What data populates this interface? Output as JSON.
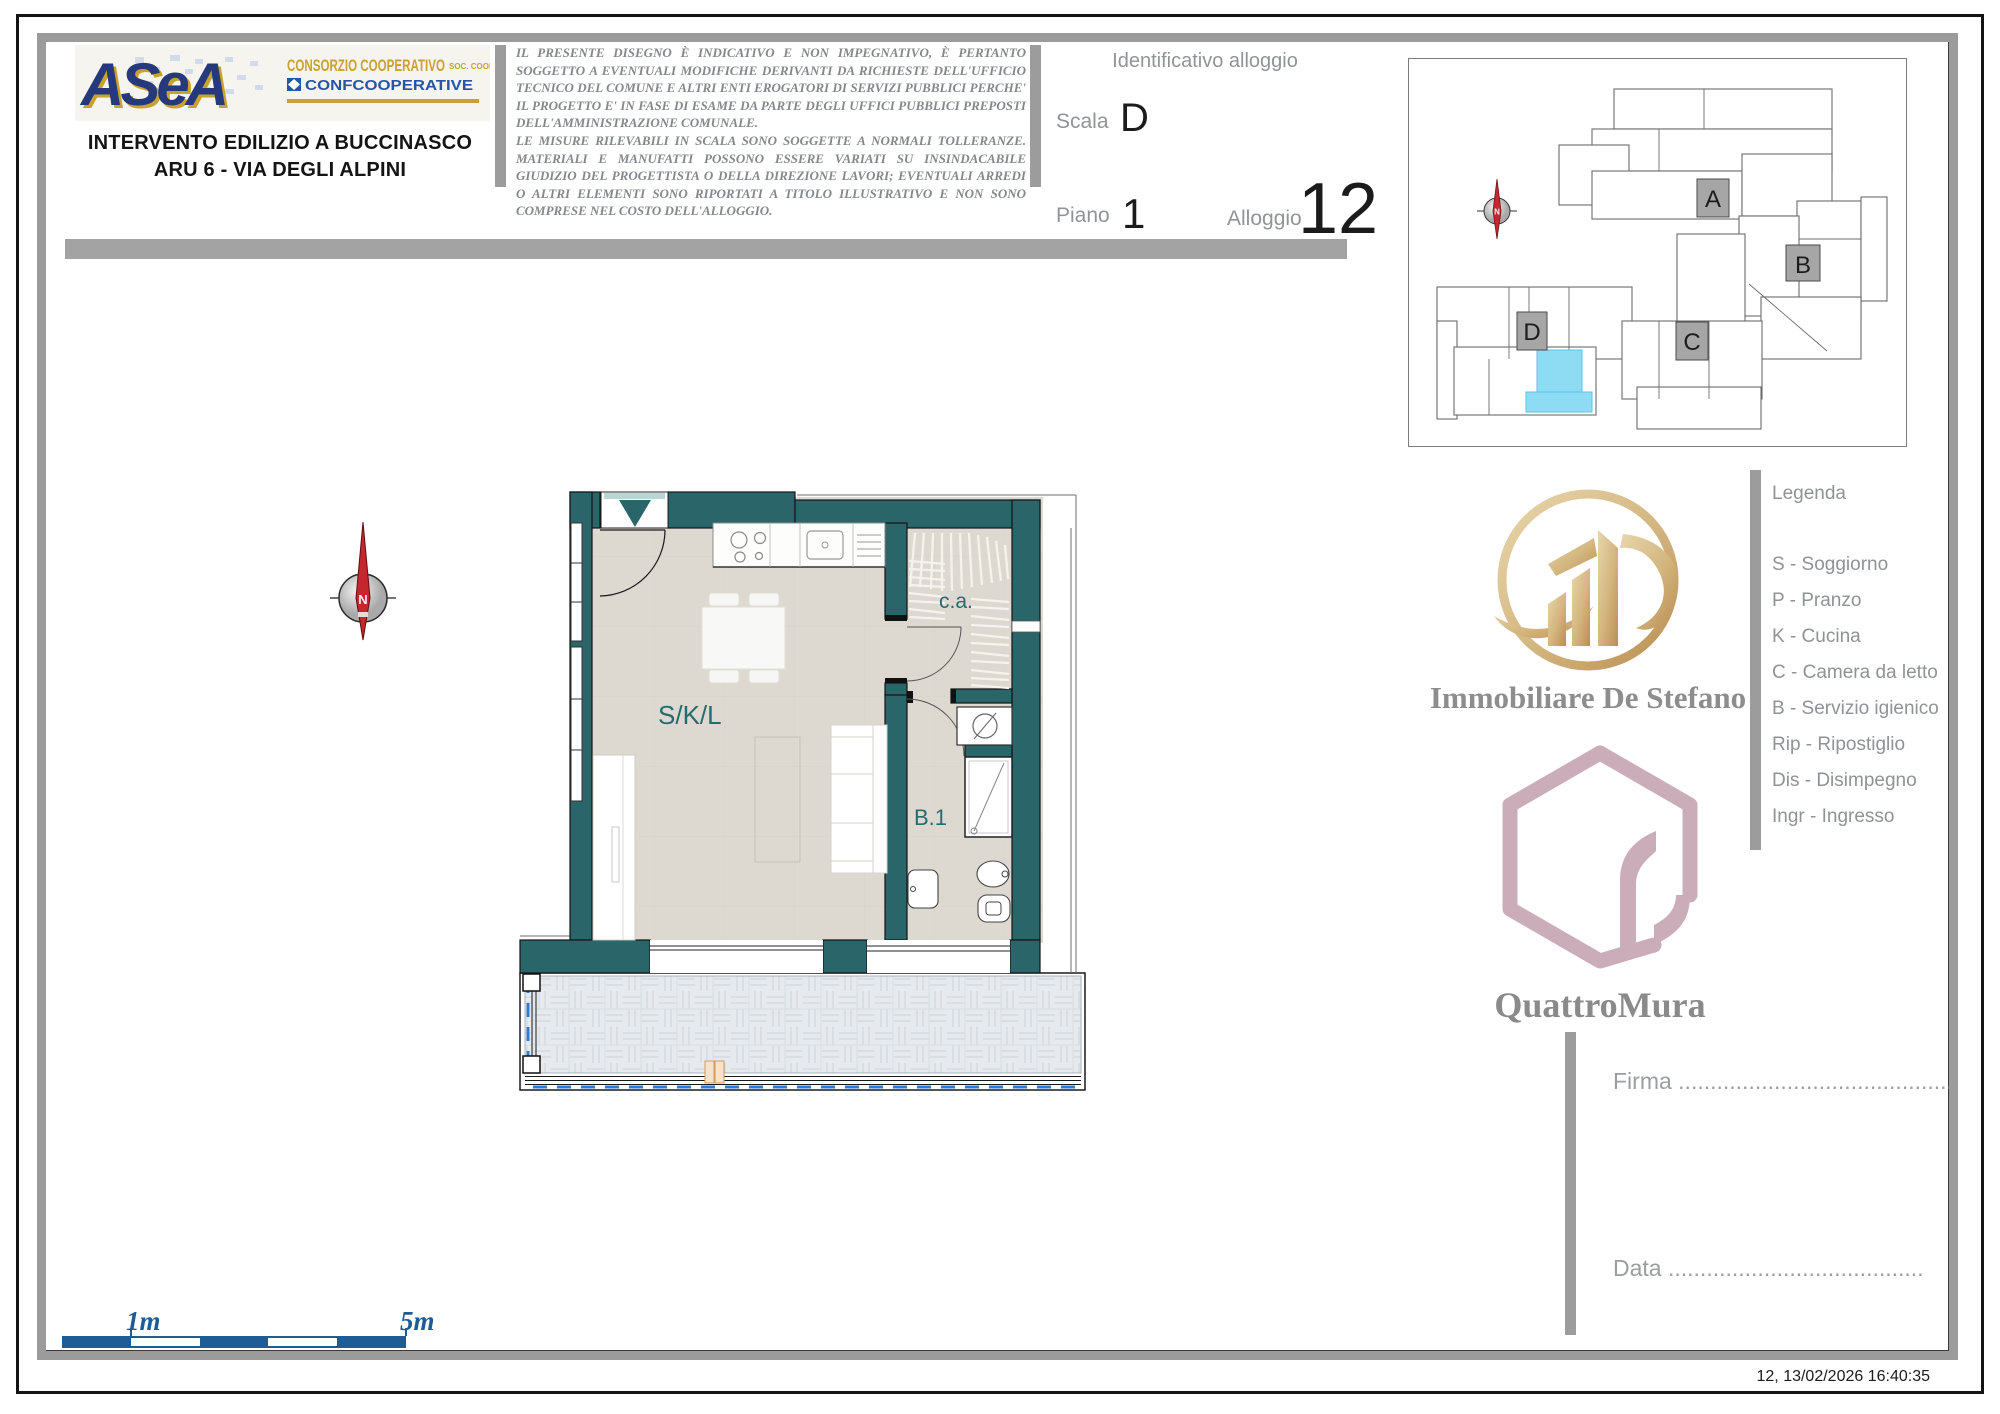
{
  "header": {
    "logo": {
      "brand": "ASeA",
      "tagline_main": "CONSORZIO COOPERATIVO",
      "tagline_suffix": "SOC. COOP.",
      "federation": "CONFCOOPERATIVE"
    },
    "title_line1": "INTERVENTO EDILIZIO A BUCCINASCO",
    "title_line2": "ARU 6 - VIA DEGLI ALPINI",
    "disclaimer_p1": "IL PRESENTE DISEGNO È INDICATIVO E NON IMPEGNATIVO, È PERTANTO SOGGETTO A EVENTUALI MODIFICHE DERIVANTI DA RICHIESTE DELL'UFFICIO TECNICO DEL COMUNE E ALTRI ENTI EROGATORI DI SERVIZI PUBBLICI PERCHE' IL PROGETTO E' IN FASE DI ESAME DA PARTE DEGLI UFFICI PUBBLICI PREPOSTI DELL'AMMINISTRAZIONE COMUNALE.",
    "disclaimer_p2": "LE MISURE RILEVABILI IN SCALA SONO SOGGETTE A NORMALI TOLLERANZE. MATERIALI E MANUFATTI POSSONO ESSERE VARIATI SU INSINDACABILE GIUDIZIO DEL PROGETTISTA O DELLA DIREZIONE LAVORI; EVENTUALI ARREDI O ALTRI ELEMENTI SONO RIPORTATI A TITOLO ILLUSTRATIVO E NON SONO COMPRESE NEL COSTO DELL'ALLOGGIO."
  },
  "unit_id": {
    "section_title": "Identificativo alloggio",
    "scala_label": "Scala",
    "scala_value": "D",
    "piano_label": "Piano",
    "piano_value": "1",
    "alloggio_label": "Alloggio",
    "alloggio_value": "12"
  },
  "site_plan": {
    "blocks": [
      "A",
      "B",
      "C",
      "D"
    ]
  },
  "floor_plan": {
    "labels": {
      "living": "S/K/L",
      "closet": "c.a.",
      "bath": "B.1"
    },
    "compass": "N",
    "colors": {
      "wall": "#2a6569",
      "floor": "#ddd9d0",
      "balcony_tile": "#e6eaee",
      "room_label": "#256b70",
      "highlight_unit": "#8edcf3",
      "dashed_line": "#2e7cd6"
    }
  },
  "branding": {
    "agency": "Immobiliare De Stefano",
    "builder": "QuattroMura",
    "agency_gold": "#c9a96e",
    "builder_mauve": "#cbadb9"
  },
  "legend": {
    "title": "Legenda",
    "items": [
      "S - Soggiorno",
      "P - Pranzo",
      "K - Cucina",
      "C - Camera da letto",
      "B - Servizio igienico",
      "Rip - Ripostiglio",
      "Dis - Disimpegno",
      "Ingr - Ingresso"
    ]
  },
  "signature": {
    "firma": "Firma ...........................................",
    "data": "Data ........................................"
  },
  "scale_bar": {
    "start": "1m",
    "end": "5m",
    "color": "#1d5c94"
  },
  "footer": {
    "timestamp": "12, 13/02/2026 16:40:35"
  }
}
